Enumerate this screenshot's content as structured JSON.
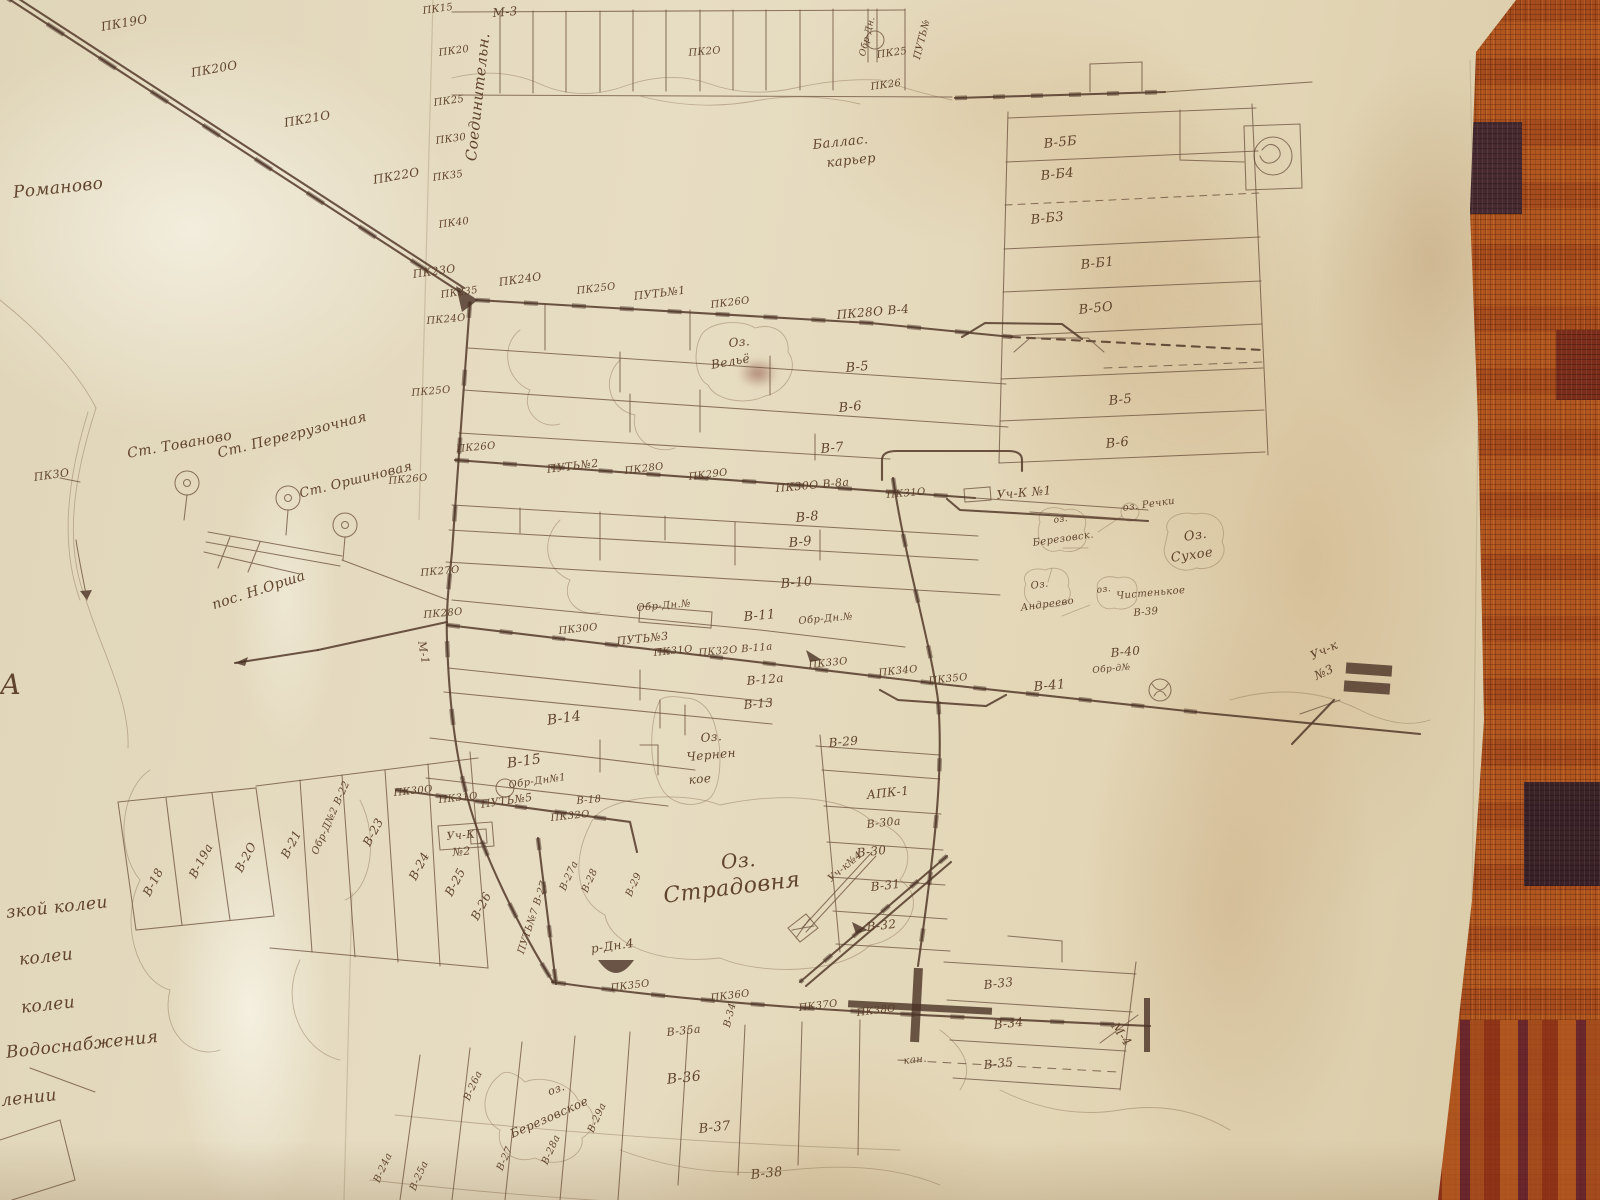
{
  "photo": {
    "subject": "hand-drawn peat railway survey map on aged paper, pinned over an orange woven carpet",
    "colors": {
      "paper": "#e4d9bc",
      "ink": "#6e5340",
      "railway": "#54392a",
      "carpet": "#b0561e",
      "carpet_dark": "#32202f",
      "stain": "#bf9664"
    },
    "symbols": {
      "station": "circle-with-center-dot-on-stem",
      "boxed-station": "square-with-scribbled-circle",
      "reservoir": "filled-half-disc",
      "siding": "trapezoid-loop",
      "section-terminal": "hatched-bars"
    }
  },
  "map": {
    "labels": [
      {
        "t": "ПК19О",
        "x": 100,
        "y": 20,
        "r": -10,
        "s": 12
      },
      {
        "t": "ПК20О",
        "x": 190,
        "y": 66,
        "r": -10,
        "s": 12
      },
      {
        "t": "ПК21О",
        "x": 283,
        "y": 116,
        "r": -10,
        "s": 12
      },
      {
        "t": "ПК22О",
        "x": 372,
        "y": 173,
        "r": -10,
        "s": 12
      },
      {
        "t": "Романово",
        "x": 12,
        "y": 183,
        "r": -6,
        "s": 17
      },
      {
        "t": "ПК23О",
        "x": 412,
        "y": 268,
        "r": -8,
        "s": 11
      },
      {
        "t": "ПК235",
        "x": 440,
        "y": 290,
        "r": -8,
        "s": 10
      },
      {
        "t": "ПК24О",
        "x": 498,
        "y": 276,
        "r": -8,
        "s": 11
      },
      {
        "t": "Соединительн.",
        "x": 462,
        "y": 160,
        "r": -84,
        "s": 15
      },
      {
        "t": "ПК15",
        "x": 422,
        "y": 6,
        "r": -8,
        "s": 10
      },
      {
        "t": "М-3",
        "x": 492,
        "y": 6,
        "r": -5,
        "s": 12
      },
      {
        "t": "ПК20",
        "x": 438,
        "y": 48,
        "r": -8,
        "s": 10
      },
      {
        "t": "ПК25",
        "x": 433,
        "y": 98,
        "r": -8,
        "s": 10
      },
      {
        "t": "ПК30",
        "x": 435,
        "y": 136,
        "r": -8,
        "s": 10
      },
      {
        "t": "ПК35",
        "x": 432,
        "y": 173,
        "r": -8,
        "s": 10
      },
      {
        "t": "ПК40",
        "x": 438,
        "y": 220,
        "r": -8,
        "s": 10
      },
      {
        "t": "ПК2О",
        "x": 688,
        "y": 48,
        "r": -5,
        "s": 10
      },
      {
        "t": "Обр-Дн.",
        "x": 858,
        "y": 55,
        "r": -76,
        "s": 9
      },
      {
        "t": "ПК25",
        "x": 876,
        "y": 50,
        "r": -8,
        "s": 10
      },
      {
        "t": "ПК26",
        "x": 870,
        "y": 82,
        "r": -8,
        "s": 10
      },
      {
        "t": "ПУТЬ№",
        "x": 912,
        "y": 58,
        "r": -76,
        "s": 10
      },
      {
        "t": "Баллас.",
        "x": 812,
        "y": 138,
        "r": -6,
        "s": 13
      },
      {
        "t": "карьер",
        "x": 826,
        "y": 156,
        "r": -6,
        "s": 13
      },
      {
        "t": "В-5Б",
        "x": 1043,
        "y": 137,
        "r": -6,
        "s": 13
      },
      {
        "t": "В-Б4",
        "x": 1040,
        "y": 169,
        "r": -6,
        "s": 13
      },
      {
        "t": "В-Б3",
        "x": 1030,
        "y": 213,
        "r": -6,
        "s": 13
      },
      {
        "t": "В-Б1",
        "x": 1080,
        "y": 258,
        "r": -6,
        "s": 13
      },
      {
        "t": "В-5О",
        "x": 1078,
        "y": 303,
        "r": -6,
        "s": 13
      },
      {
        "t": "В-5",
        "x": 1108,
        "y": 394,
        "r": -6,
        "s": 13
      },
      {
        "t": "В-6",
        "x": 1105,
        "y": 437,
        "r": -6,
        "s": 13
      },
      {
        "t": "ПК25О",
        "x": 576,
        "y": 286,
        "r": -7,
        "s": 10
      },
      {
        "t": "ПУТЬ№1",
        "x": 633,
        "y": 290,
        "r": -7,
        "s": 11
      },
      {
        "t": "ПК26О",
        "x": 710,
        "y": 300,
        "r": -7,
        "s": 10
      },
      {
        "t": "ПК28О В-4",
        "x": 836,
        "y": 308,
        "r": -5,
        "s": 12
      },
      {
        "t": "Оз.",
        "x": 728,
        "y": 336,
        "r": -5,
        "s": 12
      },
      {
        "t": "Вельё",
        "x": 710,
        "y": 358,
        "r": -10,
        "s": 12
      },
      {
        "t": "В-5",
        "x": 845,
        "y": 361,
        "r": -5,
        "s": 13
      },
      {
        "t": "В-6",
        "x": 838,
        "y": 401,
        "r": -5,
        "s": 13
      },
      {
        "t": "В-7",
        "x": 820,
        "y": 442,
        "r": -5,
        "s": 13
      },
      {
        "t": "ПК24О",
        "x": 426,
        "y": 316,
        "r": -5,
        "s": 10
      },
      {
        "t": "ПК25О",
        "x": 411,
        "y": 388,
        "r": -5,
        "s": 10
      },
      {
        "t": "ПК26О",
        "x": 456,
        "y": 444,
        "r": -5,
        "s": 10
      },
      {
        "t": "ПК26О",
        "x": 388,
        "y": 476,
        "r": -5,
        "s": 10
      },
      {
        "t": "ПК27О",
        "x": 420,
        "y": 568,
        "r": -5,
        "s": 10
      },
      {
        "t": "ПК28О",
        "x": 423,
        "y": 610,
        "r": -5,
        "s": 10
      },
      {
        "t": "М-1",
        "x": 428,
        "y": 640,
        "r": 80,
        "s": 11
      },
      {
        "t": "ПК3О",
        "x": 33,
        "y": 471,
        "r": -8,
        "s": 11
      },
      {
        "t": "Ст. Тованово",
        "x": 126,
        "y": 446,
        "r": -10,
        "s": 14
      },
      {
        "t": "Ст. Перегрузочная",
        "x": 216,
        "y": 446,
        "r": -14,
        "s": 14
      },
      {
        "t": "Ст. Оршиновая",
        "x": 298,
        "y": 487,
        "r": -14,
        "s": 13
      },
      {
        "t": "пос. Н.Орша",
        "x": 210,
        "y": 598,
        "r": -18,
        "s": 14
      },
      {
        "t": "ПУТЬ№2",
        "x": 546,
        "y": 463,
        "r": -7,
        "s": 11
      },
      {
        "t": "ПК28О",
        "x": 624,
        "y": 466,
        "r": -7,
        "s": 10
      },
      {
        "t": "ПК29О",
        "x": 688,
        "y": 472,
        "r": -7,
        "s": 10
      },
      {
        "t": "ПК30О В-8а",
        "x": 775,
        "y": 482,
        "r": -5,
        "s": 11
      },
      {
        "t": "ПК31О",
        "x": 886,
        "y": 490,
        "r": -5,
        "s": 10
      },
      {
        "t": "Уч-К №1",
        "x": 996,
        "y": 488,
        "r": -5,
        "s": 12
      },
      {
        "t": "В-8",
        "x": 795,
        "y": 511,
        "r": -5,
        "s": 13
      },
      {
        "t": "В-9",
        "x": 788,
        "y": 536,
        "r": -5,
        "s": 13
      },
      {
        "t": "В-10",
        "x": 780,
        "y": 577,
        "r": -5,
        "s": 13
      },
      {
        "t": "оз. Речки",
        "x": 1122,
        "y": 503,
        "r": -8,
        "s": 10
      },
      {
        "t": "Оз.",
        "x": 1183,
        "y": 530,
        "r": -8,
        "s": 13
      },
      {
        "t": "Сухое",
        "x": 1170,
        "y": 551,
        "r": -8,
        "s": 13
      },
      {
        "t": "оз.",
        "x": 1053,
        "y": 516,
        "r": -8,
        "s": 9
      },
      {
        "t": "Березовск.",
        "x": 1032,
        "y": 538,
        "r": -8,
        "s": 10
      },
      {
        "t": "Оз.",
        "x": 1030,
        "y": 581,
        "r": -8,
        "s": 10
      },
      {
        "t": "Андреево",
        "x": 1020,
        "y": 603,
        "r": -8,
        "s": 10
      },
      {
        "t": "оз.",
        "x": 1096,
        "y": 586,
        "r": -8,
        "s": 9
      },
      {
        "t": "Чистенькое",
        "x": 1116,
        "y": 591,
        "r": -5,
        "s": 10
      },
      {
        "t": "В-39",
        "x": 1133,
        "y": 608,
        "r": -5,
        "s": 10
      },
      {
        "t": "Обр-Дн.№",
        "x": 636,
        "y": 603,
        "r": -5,
        "s": 10
      },
      {
        "t": "В-11",
        "x": 743,
        "y": 610,
        "r": -5,
        "s": 13
      },
      {
        "t": "Обр-Дн.№",
        "x": 798,
        "y": 616,
        "r": -5,
        "s": 10
      },
      {
        "t": "ПК30О",
        "x": 558,
        "y": 626,
        "r": -6,
        "s": 10
      },
      {
        "t": "ПУТЬ№3",
        "x": 616,
        "y": 635,
        "r": -6,
        "s": 11
      },
      {
        "t": "ПК31О",
        "x": 653,
        "y": 648,
        "r": -6,
        "s": 10
      },
      {
        "t": "ПК32О В-11а",
        "x": 698,
        "y": 648,
        "r": -5,
        "s": 10
      },
      {
        "t": "ПК33О",
        "x": 808,
        "y": 660,
        "r": -6,
        "s": 10
      },
      {
        "t": "ПК34О",
        "x": 878,
        "y": 668,
        "r": -6,
        "s": 10
      },
      {
        "t": "ПК35О",
        "x": 928,
        "y": 676,
        "r": -6,
        "s": 10
      },
      {
        "t": "В-12а",
        "x": 746,
        "y": 674,
        "r": -5,
        "s": 12
      },
      {
        "t": "В-13",
        "x": 743,
        "y": 698,
        "r": -5,
        "s": 12
      },
      {
        "t": "В-41",
        "x": 1033,
        "y": 680,
        "r": -5,
        "s": 13
      },
      {
        "t": "В-40",
        "x": 1110,
        "y": 646,
        "r": -5,
        "s": 12
      },
      {
        "t": "Обр-д№",
        "x": 1092,
        "y": 666,
        "r": -5,
        "s": 9
      },
      {
        "t": "Уч-к",
        "x": 1308,
        "y": 650,
        "r": -25,
        "s": 12
      },
      {
        "t": "№3",
        "x": 1312,
        "y": 670,
        "r": -25,
        "s": 12
      },
      {
        "t": "В-14",
        "x": 546,
        "y": 713,
        "r": -8,
        "s": 14
      },
      {
        "t": "В-15",
        "x": 506,
        "y": 756,
        "r": -8,
        "s": 14
      },
      {
        "t": "Обр-Дн№1",
        "x": 508,
        "y": 780,
        "r": -8,
        "s": 10
      },
      {
        "t": "ПК30О",
        "x": 393,
        "y": 788,
        "r": -6,
        "s": 10
      },
      {
        "t": "ПК31О",
        "x": 438,
        "y": 795,
        "r": -6,
        "s": 10
      },
      {
        "t": "ПУТЬ№5",
        "x": 480,
        "y": 798,
        "r": -8,
        "s": 11
      },
      {
        "t": "В-18",
        "x": 576,
        "y": 796,
        "r": -5,
        "s": 10
      },
      {
        "t": "ПК32О",
        "x": 550,
        "y": 813,
        "r": -6,
        "s": 10
      },
      {
        "t": "Уч-К",
        "x": 446,
        "y": 830,
        "r": -5,
        "s": 11
      },
      {
        "t": "№2",
        "x": 452,
        "y": 846,
        "r": -5,
        "s": 11
      },
      {
        "t": "Оз.",
        "x": 700,
        "y": 731,
        "r": -5,
        "s": 12
      },
      {
        "t": "Чернен",
        "x": 686,
        "y": 750,
        "r": -5,
        "s": 12
      },
      {
        "t": "кое",
        "x": 688,
        "y": 773,
        "r": -5,
        "s": 12
      },
      {
        "t": "В-29",
        "x": 828,
        "y": 736,
        "r": -5,
        "s": 12
      },
      {
        "t": "АПК-1",
        "x": 866,
        "y": 788,
        "r": -6,
        "s": 12
      },
      {
        "t": "В-30а",
        "x": 866,
        "y": 818,
        "r": -6,
        "s": 11
      },
      {
        "t": "В-30",
        "x": 856,
        "y": 846,
        "r": -6,
        "s": 12
      },
      {
        "t": "Уч-к№4",
        "x": 826,
        "y": 876,
        "r": -40,
        "s": 10
      },
      {
        "t": "В-31",
        "x": 870,
        "y": 880,
        "r": -6,
        "s": 12
      },
      {
        "t": "В-32",
        "x": 866,
        "y": 920,
        "r": -6,
        "s": 12
      },
      {
        "t": "Оз.",
        "x": 720,
        "y": 850,
        "r": -5,
        "s": 20
      },
      {
        "t": "Страдовня",
        "x": 662,
        "y": 884,
        "r": -7,
        "s": 22
      },
      {
        "t": "р-Дн.4",
        "x": 590,
        "y": 942,
        "r": -8,
        "s": 12
      },
      {
        "t": "В-18",
        "x": 140,
        "y": 892,
        "r": -62,
        "s": 12
      },
      {
        "t": "В-19а",
        "x": 186,
        "y": 874,
        "r": -62,
        "s": 12
      },
      {
        "t": "В-2О",
        "x": 232,
        "y": 868,
        "r": -62,
        "s": 12
      },
      {
        "t": "В-21",
        "x": 278,
        "y": 854,
        "r": -62,
        "s": 12
      },
      {
        "t": "Обр-Д№2 В-22",
        "x": 310,
        "y": 852,
        "r": -66,
        "s": 10
      },
      {
        "t": "В-23",
        "x": 360,
        "y": 842,
        "r": -62,
        "s": 12
      },
      {
        "t": "В-24",
        "x": 406,
        "y": 876,
        "r": -62,
        "s": 12
      },
      {
        "t": "В-25",
        "x": 442,
        "y": 892,
        "r": -62,
        "s": 12
      },
      {
        "t": "В-26",
        "x": 468,
        "y": 916,
        "r": -62,
        "s": 12
      },
      {
        "t": "ПУТЬ№7 В-27",
        "x": 516,
        "y": 952,
        "r": -72,
        "s": 10
      },
      {
        "t": "В-27а",
        "x": 558,
        "y": 888,
        "r": -66,
        "s": 10
      },
      {
        "t": "В-28",
        "x": 580,
        "y": 890,
        "r": -66,
        "s": 10
      },
      {
        "t": "В-29",
        "x": 624,
        "y": 894,
        "r": -66,
        "s": 10
      },
      {
        "t": "зкой колеи",
        "x": 5,
        "y": 903,
        "r": -6,
        "s": 17
      },
      {
        "t": "колеи",
        "x": 18,
        "y": 950,
        "r": -6,
        "s": 17
      },
      {
        "t": "колеи",
        "x": 20,
        "y": 998,
        "r": -6,
        "s": 17
      },
      {
        "t": "Водоснабжения",
        "x": 5,
        "y": 1043,
        "r": -6,
        "s": 17
      },
      {
        "t": "лении",
        "x": 0,
        "y": 1091,
        "r": -6,
        "s": 17
      },
      {
        "t": "А",
        "x": 0,
        "y": 668,
        "r": 0,
        "s": 28
      },
      {
        "t": "ПК35О",
        "x": 610,
        "y": 983,
        "r": -7,
        "s": 10
      },
      {
        "t": "ПК36О",
        "x": 710,
        "y": 993,
        "r": -7,
        "s": 10
      },
      {
        "t": "ПК37О",
        "x": 798,
        "y": 1003,
        "r": -7,
        "s": 10
      },
      {
        "t": "ПК38О",
        "x": 856,
        "y": 1008,
        "r": -7,
        "s": 10
      },
      {
        "t": "В-33",
        "x": 983,
        "y": 978,
        "r": -6,
        "s": 12
      },
      {
        "t": "В-34",
        "x": 993,
        "y": 1018,
        "r": -6,
        "s": 12
      },
      {
        "t": "кан.",
        "x": 903,
        "y": 1056,
        "r": -6,
        "s": 10
      },
      {
        "t": "В-35",
        "x": 983,
        "y": 1058,
        "r": -6,
        "s": 12
      },
      {
        "t": "М-4",
        "x": 1120,
        "y": 1020,
        "r": 55,
        "s": 12
      },
      {
        "t": "В-35а",
        "x": 666,
        "y": 1026,
        "r": -6,
        "s": 11
      },
      {
        "t": "В-34",
        "x": 722,
        "y": 1026,
        "r": -76,
        "s": 10
      },
      {
        "t": "В-36",
        "x": 666,
        "y": 1072,
        "r": -6,
        "s": 14
      },
      {
        "t": "В-37",
        "x": 698,
        "y": 1122,
        "r": -6,
        "s": 13
      },
      {
        "t": "В-38",
        "x": 750,
        "y": 1168,
        "r": -6,
        "s": 13
      },
      {
        "t": "оз.",
        "x": 546,
        "y": 1086,
        "r": -20,
        "s": 11
      },
      {
        "t": "Березовское",
        "x": 508,
        "y": 1128,
        "r": -24,
        "s": 12
      },
      {
        "t": "В-26а",
        "x": 462,
        "y": 1098,
        "r": -66,
        "s": 10
      },
      {
        "t": "В-27",
        "x": 495,
        "y": 1168,
        "r": -66,
        "s": 10
      },
      {
        "t": "В-28а",
        "x": 540,
        "y": 1162,
        "r": -66,
        "s": 10
      },
      {
        "t": "В-29а",
        "x": 586,
        "y": 1130,
        "r": -66,
        "s": 10
      },
      {
        "t": "В-24а",
        "x": 372,
        "y": 1180,
        "r": -66,
        "s": 10
      },
      {
        "t": "В-25а",
        "x": 408,
        "y": 1188,
        "r": -66,
        "s": 10
      }
    ]
  }
}
